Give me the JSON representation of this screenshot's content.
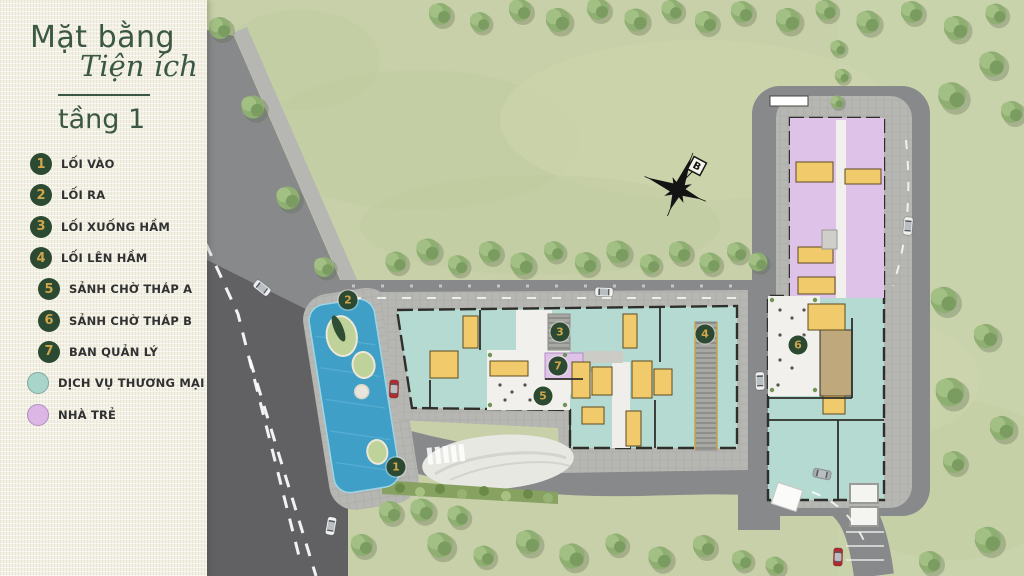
{
  "page": {
    "title_line1": "Mặt bằng",
    "title_line2": "Tiện ích",
    "floor_label": "tầng 1"
  },
  "legend": {
    "numbered_items": [
      {
        "num": "1",
        "label": "LỐI VÀO"
      },
      {
        "num": "2",
        "label": "LỐI RA"
      },
      {
        "num": "3",
        "label": "LỐI XUỐNG HẦM"
      },
      {
        "num": "4",
        "label": "LỐI LÊN HẦM"
      },
      {
        "num": "5",
        "label": "SẢNH CHỜ THÁP A"
      },
      {
        "num": "6",
        "label": "SẢNH CHỜ THÁP B"
      },
      {
        "num": "7",
        "label": "BAN QUẢN LÝ"
      }
    ],
    "swatch_items": [
      {
        "label": "DỊCH VỤ THƯƠNG MẠI",
        "color": "#a9d4c9"
      },
      {
        "label": "NHÀ TRẺ",
        "color": "#dcb7e6"
      }
    ]
  },
  "map": {
    "compass_label": "B",
    "markers": [
      {
        "num": "1",
        "x": 396,
        "y": 467
      },
      {
        "num": "2",
        "x": 348,
        "y": 300
      },
      {
        "num": "3",
        "x": 560,
        "y": 332
      },
      {
        "num": "4",
        "x": 705,
        "y": 334
      },
      {
        "num": "5",
        "x": 543,
        "y": 396
      },
      {
        "num": "6",
        "x": 798,
        "y": 345
      },
      {
        "num": "7",
        "x": 558,
        "y": 366
      }
    ],
    "colors": {
      "grass": "#c7d0a8",
      "road": "#87898b",
      "asphalt_dark": "#616164",
      "sidewalk": "#b6b6b2",
      "commercial_fill": "#b5dad1",
      "kindergarten_fill": "#dec2e8",
      "core_fill": "#f0ca6b",
      "lobby_fill": "#f1f0ec",
      "water": "#3f9fc7",
      "marker_bg": "#2c4a31",
      "marker_num": "#cda64d",
      "title_green": "#3a5843"
    }
  }
}
